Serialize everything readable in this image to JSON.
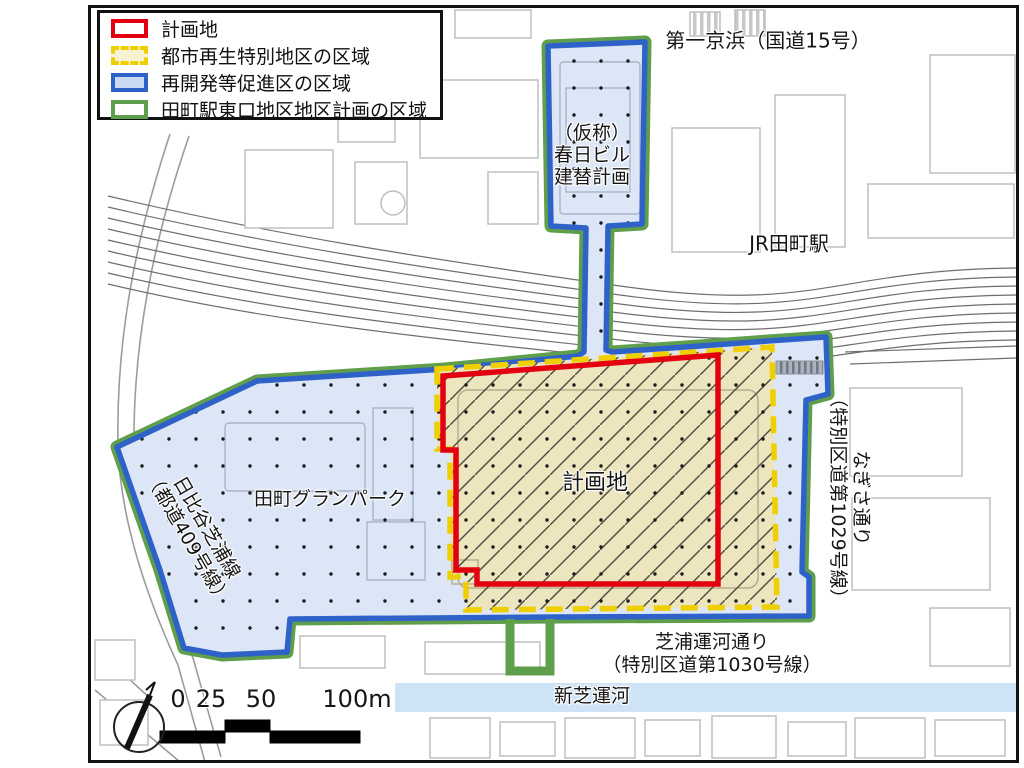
{
  "legend": {
    "items": [
      {
        "label": "計画地"
      },
      {
        "label": "都市再生特別地区の区域"
      },
      {
        "label": "再開発等促進区の区域"
      },
      {
        "label": "田町駅東口地区地区計画の区域"
      }
    ]
  },
  "labels": {
    "route15": "第一京浜（国道15号）",
    "kasuga_line1": "（仮称）",
    "kasuga_line2": "春日ビル",
    "kasuga_line3": "建替計画",
    "station": "JR田町駅",
    "site": "計画地",
    "granpark": "田町グランパーク",
    "hibiya_line1": "日比谷芝浦線",
    "hibiya_line2": "（都道409号線）",
    "nagisa_line1": "なぎさ通り",
    "nagisa_line2": "（特別区道第1029号線）",
    "shibaura_line1": "芝浦運河通り",
    "shibaura_line2": "（特別区道第1030号線）",
    "canal": "新芝運河"
  },
  "scale": {
    "t0": "0",
    "t25": "25",
    "t50": "50",
    "t100": "100m"
  },
  "colors": {
    "site_outline_red": "#e3000f",
    "special_district_yellow": "#f0cf00",
    "promotion_blue": "#2f62c8",
    "district_plan_green": "#5f9e4a",
    "promotion_fill": "#dce6f7",
    "site_fill": "#ece5bd",
    "canal_fill": "#cfe3f6"
  }
}
